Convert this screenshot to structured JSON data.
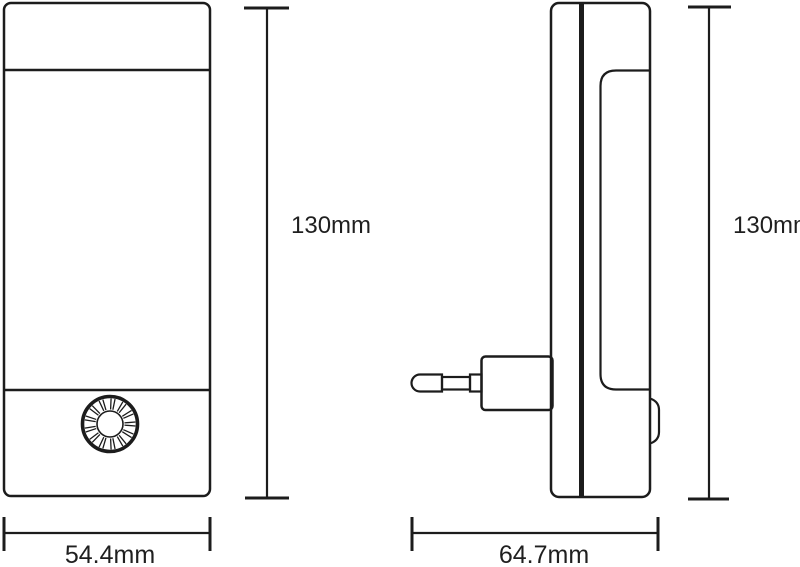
{
  "figure": {
    "type": "technical dimension drawing",
    "subject": "plug-in night light, front and side orthographic views"
  },
  "dimensions": {
    "front_height": "130mm",
    "side_height": "130mm",
    "front_width": "54.4mm",
    "side_depth": "64.7mm"
  },
  "colors": {
    "line": "#1c1c1c",
    "text": "#1f1f1f",
    "background": "#ffffff"
  },
  "knob": {
    "cx": 110,
    "cy": 424,
    "outer_r": 27.5,
    "inner_r": 13,
    "spoke_pairs": 13,
    "spoke_inner_r": 14.5,
    "spoke_outer_r": 25.5,
    "pair_half_angle_deg": 4.5
  }
}
